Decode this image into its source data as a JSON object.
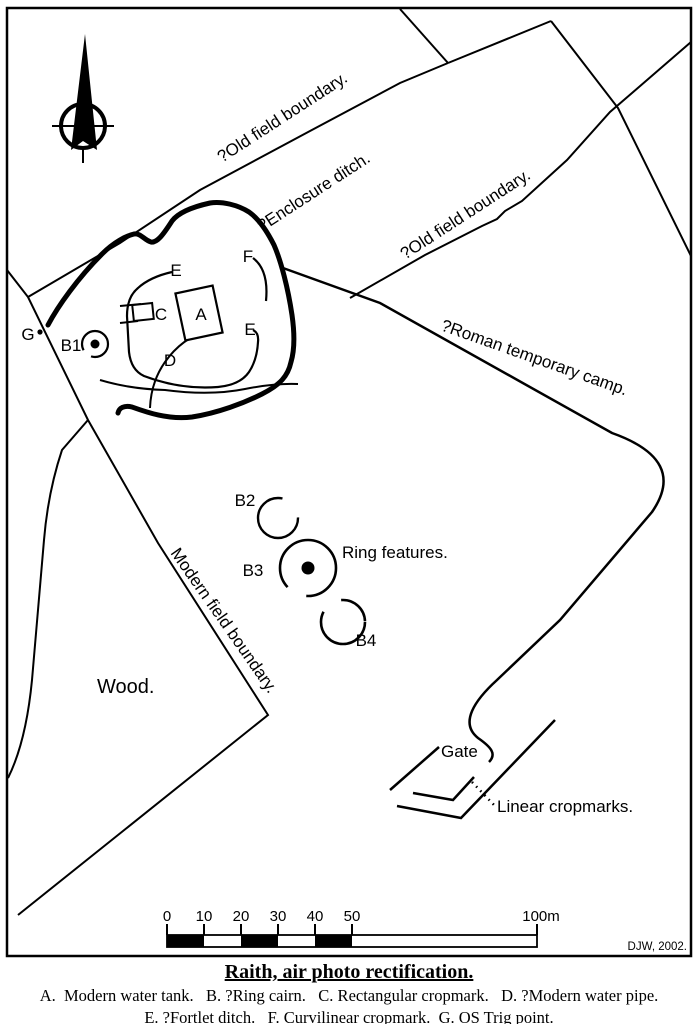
{
  "compass": {
    "letter": "N"
  },
  "labels": {
    "old_field_boundary_1": "?Old field boundary.",
    "enclosure_ditch": "?Enclosure ditch.",
    "old_field_boundary_2": "?Old field boundary.",
    "roman_camp": "?Roman temporary camp.",
    "modern_field_boundary": "Modern field boundary.",
    "wood": "Wood.",
    "ring_features": "Ring features.",
    "gate": "Gate",
    "linear_cropmarks": "Linear cropmarks."
  },
  "markers": {
    "a": "A",
    "b1": "B1",
    "b2": "B2",
    "b3": "B3",
    "b4": "B4",
    "c": "C",
    "d": "D",
    "e_upper": "E",
    "e_lower": "E",
    "f": "F",
    "g": "G"
  },
  "scale_bar": {
    "ticks": [
      "0",
      "10",
      "20",
      "30",
      "40",
      "50"
    ],
    "end_label": "100m"
  },
  "credit": "DJW, 2002.",
  "caption": {
    "title": "Raith, air photo rectification.",
    "legend_line1": "A.  Modern water tank.   B. ?Ring cairn.   C. Rectangular cropmark.   D. ?Modern water pipe.",
    "legend_line2": "E. ?Fortlet ditch.   F. Curvilinear cropmark.  G. OS Trig point."
  },
  "colors": {
    "ink": "#000000",
    "paper": "#ffffff"
  }
}
